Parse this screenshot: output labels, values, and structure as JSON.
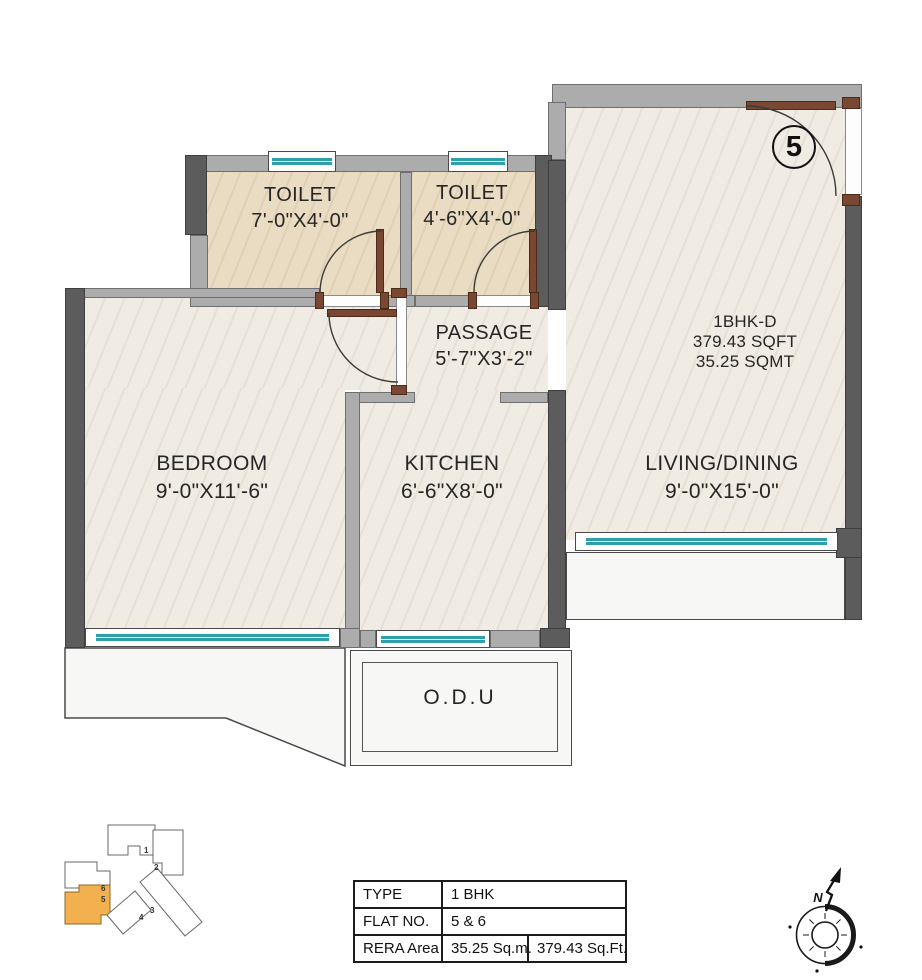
{
  "plan": {
    "unit_badge": "5",
    "unit_info": {
      "line1": "1BHK-D",
      "line2": "379.43 SQFT",
      "line3": "35.25 SQMT"
    },
    "rooms": {
      "toilet1": {
        "name": "TOILET",
        "dims": "7'-0\"X4'-0\""
      },
      "toilet2": {
        "name": "TOILET",
        "dims": "4'-6\"X4'-0\""
      },
      "passage": {
        "name": "PASSAGE",
        "dims": "5'-7\"X3'-2\""
      },
      "bedroom": {
        "name": "BEDROOM",
        "dims": "9'-0\"X11'-6\""
      },
      "kitchen": {
        "name": "KITCHEN",
        "dims": "6'-6\"X8'-0\""
      },
      "living": {
        "name": "LIVING/DINING",
        "dims": "9'-0\"X15'-0\""
      },
      "odu": {
        "name": "O.D.U"
      }
    }
  },
  "table": {
    "rows": [
      {
        "label": "TYPE",
        "values": [
          "1 BHK"
        ]
      },
      {
        "label": "FLAT NO.",
        "values": [
          "5 & 6"
        ]
      },
      {
        "label": "RERA Area",
        "values": [
          "35.25 Sq.m.",
          "379.43 Sq.Ft."
        ]
      }
    ]
  },
  "key_plan": {
    "units": [
      "1",
      "2",
      "3",
      "4",
      "5",
      "6"
    ],
    "highlighted_unit": "5",
    "highlight_color": "#f2b14e"
  },
  "compass": {
    "label": "N"
  },
  "colors": {
    "wall_dark": "#5c5c5c",
    "wall_light": "#acacac",
    "window_teal": "#2f9fae",
    "door_brown": "#7a4732",
    "floor_cream": "#f0ebe3",
    "floor_toilet": "#eadcc2",
    "keyplan_highlight": "#f2b14e"
  }
}
